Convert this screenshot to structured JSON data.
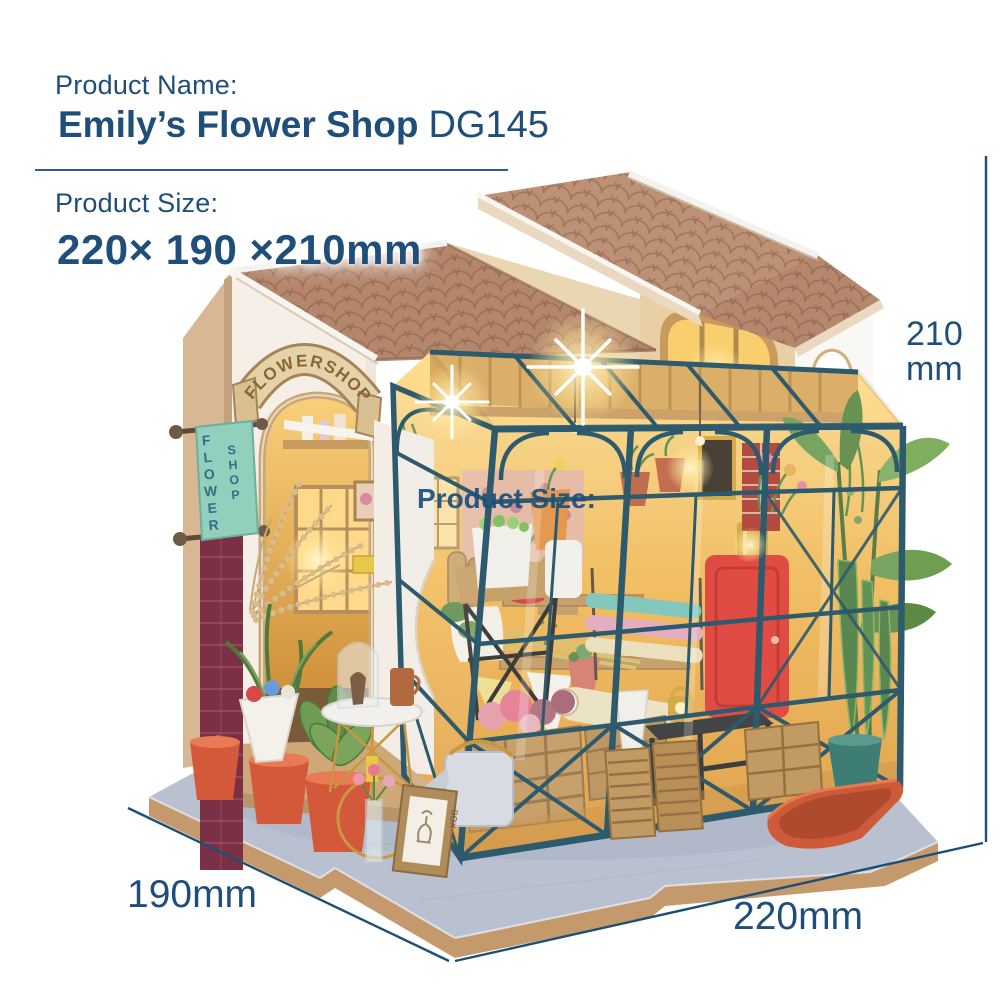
{
  "header": {
    "product_name_label": "Product Name:",
    "product_title": "Emily’s Flower Shop",
    "product_code": "DG145",
    "product_size_label": "Product Size:",
    "product_size_value": "220× 190 ×210mm"
  },
  "watermark": {
    "text": "Product Size:"
  },
  "dimensions": {
    "height_value": "210",
    "height_unit": "mm",
    "depth_label": "190mm",
    "width_label": "220mm"
  },
  "model": {
    "arch_banner_text": "FLOWERSHOP",
    "hanging_sign_word1": "FLOWER",
    "hanging_sign_word2": "SHOP",
    "frame_label": "BOX"
  },
  "colors": {
    "text_navy": "#1e4e79",
    "roof_tile": "#b5876c",
    "greenhouse_frame": "#2d5a6c",
    "wall_white": "#f6efe8",
    "wall_tan": "#d8b794",
    "dormer_cream": "#e9cfa4",
    "sign_mint": "#93cfbd",
    "brick_maroon": "#7c3046",
    "pot_orange": "#d4583a",
    "base_top": "#b9c1d1",
    "base_edge": "#c49a6c",
    "interior_glow": "#f7b94a"
  }
}
